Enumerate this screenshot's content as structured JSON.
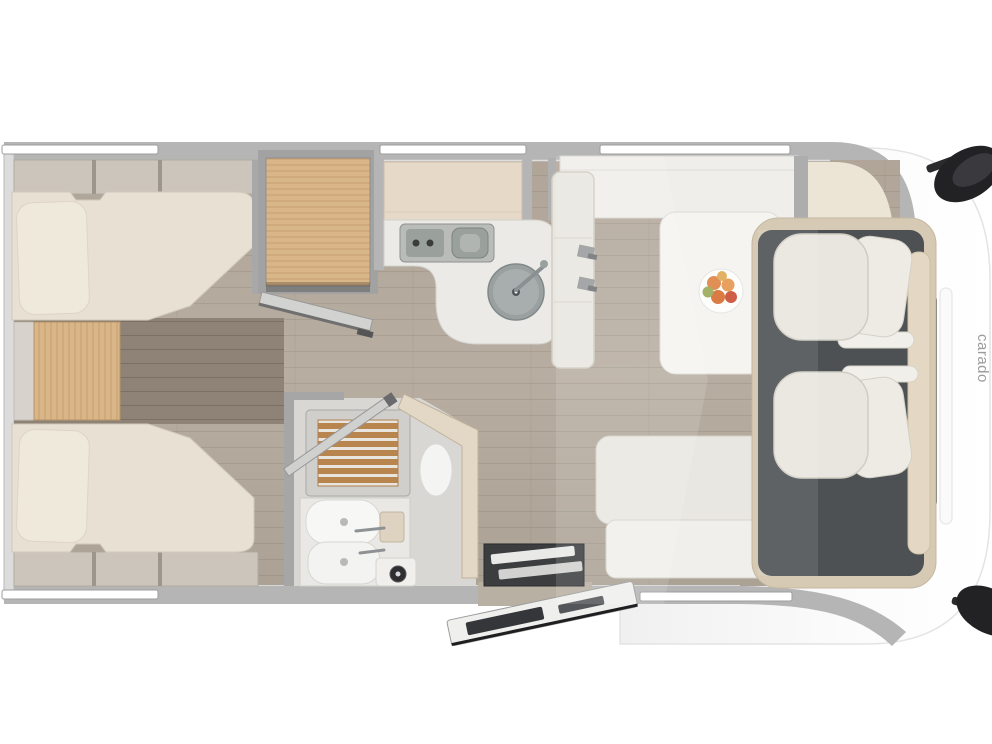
{
  "vehicle": {
    "brand_logo": "carado",
    "view": "top-down floor plan of a motorhome, rear at left, driver cab at right"
  },
  "colors": {
    "background": "#ffffff",
    "wall_gray": "#b5b5b5",
    "inner_wall": "#d9d9d9",
    "floor_wood": "#b3a99d",
    "floor_dark_wood": "#8e8376",
    "oak_wood": "#d9b687",
    "mattress": "#e7e0d3",
    "pillow": "#efe9dc",
    "counter_white": "#ebeae6",
    "sink_gray": "#9aa0a0",
    "seat_cream": "#e9e6df",
    "cab_floor": "#4d5153",
    "dashboard_beige": "#e4d8c4",
    "shower_slats": "#b9854f",
    "mirror_black": "#222224",
    "logo_gray": "#9b9b9b",
    "fruit_orange": "#e09055",
    "fruit_red": "#cd5f47",
    "fruit_green": "#a3b267"
  }
}
